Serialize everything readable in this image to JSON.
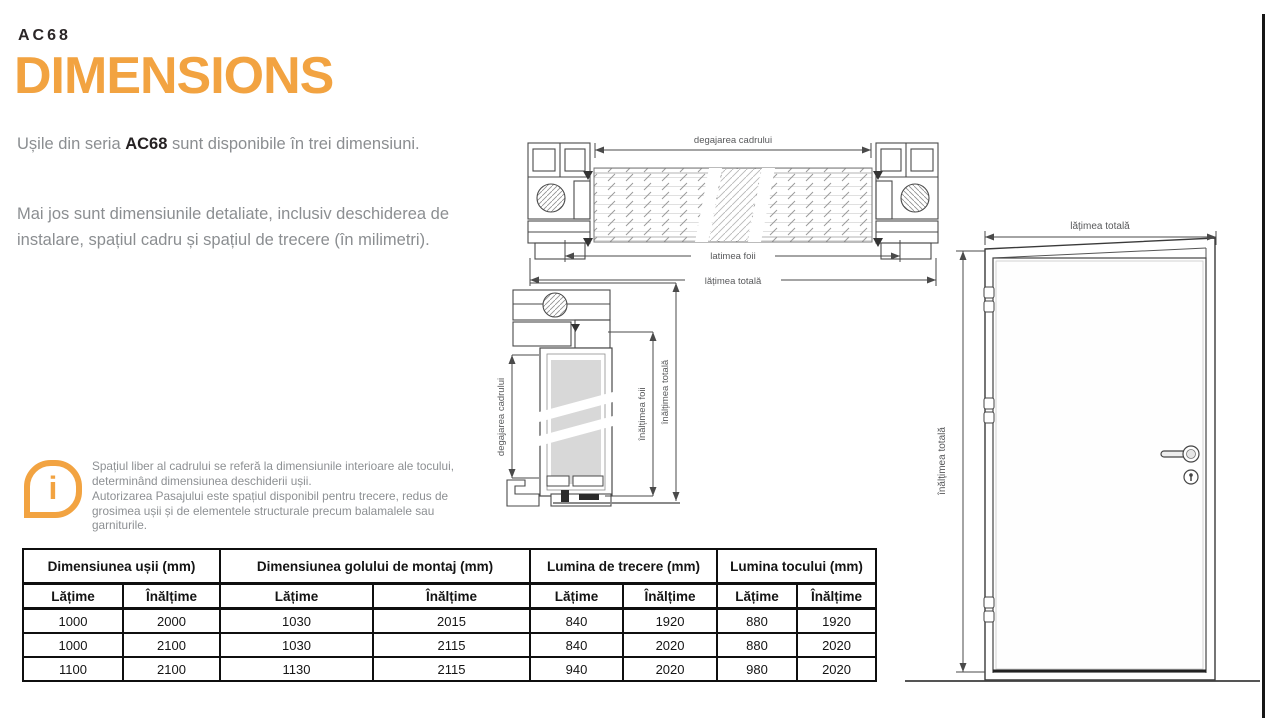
{
  "page": {
    "kicker": "AC68",
    "title": "DIMENSIONS"
  },
  "intro": {
    "lead": "Ușile din seria ",
    "brand": "AC68",
    "tail": " sunt disponibile în trei dimensiuni.",
    "paragraph2": "Mai jos sunt dimensiunile detaliate, inclusiv deschiderea de instalare, spațiul cadru și spațiul de trecere (în milimetri)."
  },
  "note": {
    "icon_glyph": "i",
    "line1": "Spațiul liber al cadrului se referă la dimensiunile interioare ale tocului, determinând dimensiunea deschiderii ușii.",
    "line2": "Autorizarea Pasajului este spațiul disponibil pentru trecere, redus de grosimea ușii și de elementele structurale precum balamalele sau garniturile."
  },
  "diagrams": {
    "horizontal_section": {
      "dim_frame_clearance": "degajarea cadrului",
      "dim_leaf_width": "latimea foii",
      "dim_total_width": "lățimea totală"
    },
    "vertical_section": {
      "dim_frame_clearance": "degajarea cadrului",
      "dim_leaf_height": "înălțimea foii",
      "dim_total_height": "înălțimea totală"
    },
    "door_front": {
      "dim_total_width": "lățimea totală",
      "dim_total_height": "înălțimea totală"
    }
  },
  "table": {
    "groups": [
      "Dimensiunea ușii (mm)",
      "Dimensiunea golului de montaj (mm)",
      "Lumina de trecere (mm)",
      "Lumina tocului (mm)"
    ],
    "subheaders": [
      "Lățime",
      "Înălțime",
      "Lățime",
      "Înălțime",
      "Lățime",
      "Înălțime",
      "Lățime",
      "Înălțime"
    ],
    "rows": [
      [
        "1000",
        "2000",
        "1030",
        "2015",
        "840",
        "1920",
        "880",
        "1920"
      ],
      [
        "1000",
        "2100",
        "1030",
        "2115",
        "840",
        "2020",
        "880",
        "2020"
      ],
      [
        "1100",
        "2100",
        "1130",
        "2115",
        "940",
        "2020",
        "980",
        "2020"
      ]
    ]
  },
  "colors": {
    "accent": "#F2A341",
    "body_text": "#8B8E91",
    "ink": "#262223",
    "table_border": "#0F0F0F"
  }
}
